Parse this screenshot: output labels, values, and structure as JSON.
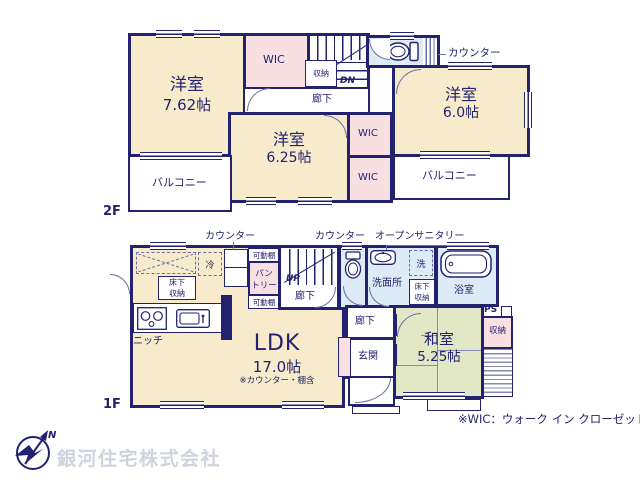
{
  "floor2": {
    "label": "2F",
    "room762_name": "洋室",
    "room762_size": "7.62帖",
    "wic_top": "WIC",
    "storage": "収納",
    "hallway": "廊下",
    "dn": "DN",
    "counter": "カウンター",
    "room60_name": "洋室",
    "room60_size": "6.0帖",
    "room625_name": "洋室",
    "room625_size": "6.25帖",
    "wic1": "WIC",
    "wic2": "WIC",
    "balcony_left": "バルコニー",
    "balcony_right": "バルコニー"
  },
  "floor1": {
    "label": "1F",
    "counter1": "カウンター",
    "counter2": "カウンター",
    "open_sanitary": "オープンサニタリー",
    "fridge": "冷",
    "underfloor1_l1": "床下",
    "underfloor1_l2": "収納",
    "shelf1": "可動棚",
    "shelf2": "可動棚",
    "pantry_l1": "パン",
    "pantry_l2": "トリー",
    "up": "UP",
    "hallway1": "廊下",
    "washroom": "洗面所",
    "washer": "洗",
    "underfloor2_l1": "床下",
    "underfloor2_l2": "収納",
    "bathroom": "浴室",
    "ps": "PS",
    "closet": "収納",
    "washitsu_name": "和室",
    "washitsu_size": "5.25帖",
    "hallway2": "廊下",
    "entrance": "玄関",
    "ldk_name": "LDK",
    "ldk_size": "17.0帖",
    "ldk_note": "※カウンター・棚含",
    "niche": "ニッチ"
  },
  "footer": {
    "company": "銀河住宅株式会社",
    "wic_note": "※WIC：ウォーク イン クローゼット",
    "compass_n": "N"
  },
  "colors": {
    "wall": "#22226f",
    "room": "#f7ebcb",
    "closet_pink": "#f8dfe1",
    "wet_blue": "#dcebf6",
    "tatami_green": "#e2e8c6"
  }
}
